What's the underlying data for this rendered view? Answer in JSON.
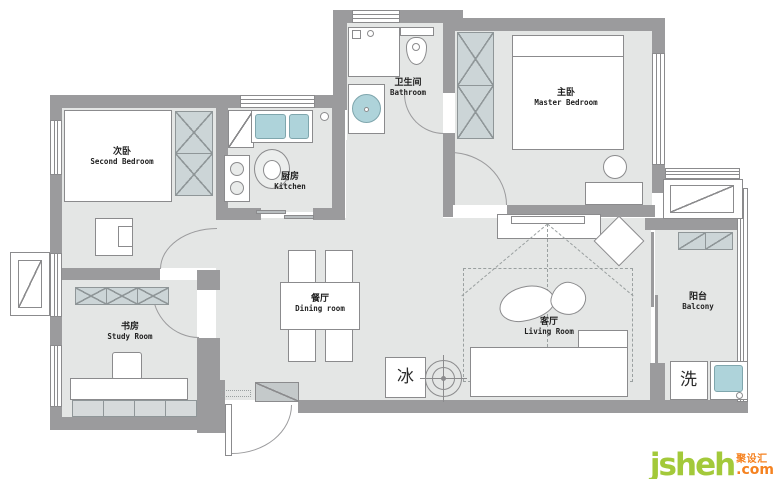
{
  "rooms": {
    "second_bedroom": {
      "zh": "次卧",
      "en": "Second Bedroom"
    },
    "study_room": {
      "zh": "书房",
      "en": "Study Room"
    },
    "kitchen": {
      "zh": "厨房",
      "en": "Kitchen"
    },
    "bathroom": {
      "zh": "卫生间",
      "en": "Bathroom"
    },
    "master_bedroom": {
      "zh": "主卧",
      "en": "Master Bedroom"
    },
    "dining_room": {
      "zh": "餐厅",
      "en": "Dining room"
    },
    "living_room": {
      "zh": "客厅",
      "en": "Living Room"
    },
    "balcony": {
      "zh": "阳台",
      "en": "Balcony"
    }
  },
  "appliances": {
    "fridge": "冰",
    "washing_machine": "洗"
  },
  "logo": {
    "brand": "jsheh",
    "tld": ".com",
    "zh": "聚设汇"
  },
  "colors": {
    "wall": "#9b9b9d",
    "floor": "#e4e6e5",
    "fixture_teal": "#aed3da",
    "cabinet_hatch": "#ccd5d7",
    "logo_green": "#a3c93a",
    "logo_orange": "#f58220"
  }
}
